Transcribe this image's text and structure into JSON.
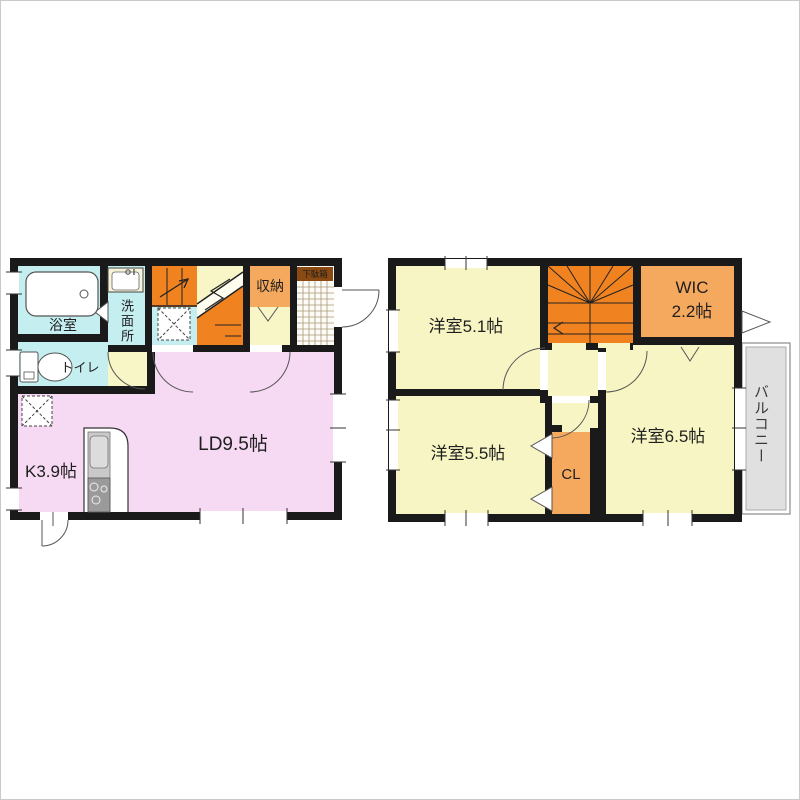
{
  "document": {
    "type": "floor-plan",
    "floors": 2
  },
  "floor1": {
    "labels": {
      "bath": "浴室",
      "washroom": "洗面所",
      "toilet": "トイレ",
      "storage": "収納",
      "shoe_cabinet": "下駄箱",
      "kitchen": "K3.9帖",
      "living_dining": "LD9.5帖"
    }
  },
  "floor2": {
    "labels": {
      "bedroom_51": "洋室5.1帖",
      "wic_line1": "WIC",
      "wic_line2": "2.2帖",
      "bedroom_55": "洋室5.5帖",
      "bedroom_65": "洋室6.5帖",
      "closet": "CL",
      "balcony": "バルコニー"
    }
  },
  "colors": {
    "wall": "#1a1a1a",
    "water_rooms_cyan": "#c5eef1",
    "hall_yellow": "#f8f6c6",
    "ldk_pink": "#f6d9f2",
    "stair_orange": "#f0831f",
    "storage_orange": "#f5a95e",
    "shoe_label_brown": "#8a4a12",
    "balcony_gray": "#e0e0e0",
    "genkan_tile": "#fdfbf5"
  }
}
